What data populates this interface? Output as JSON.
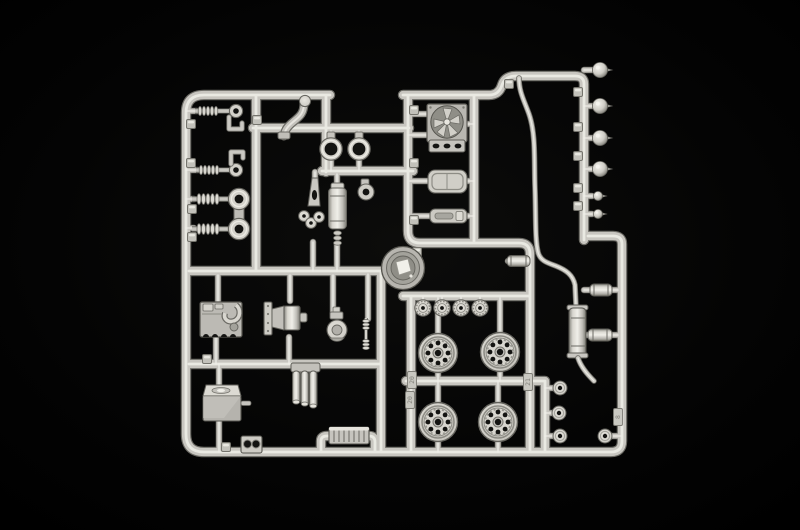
{
  "meta": {
    "description": "Photograph of a light-gray injection-molded plastic model kit sprue (parts runner) lying on a black background",
    "subject": "model-kit-sprue",
    "plastic_color_name": "light gray",
    "background_color_name": "black"
  },
  "palette": {
    "bg": "#000000",
    "vign": "#0d0d0c",
    "plastic_hi": "#efeee8",
    "plastic_mid": "#c8c6c0",
    "plastic_lo": "#a3a29b",
    "plastic_dark": "#6b6a64",
    "hole": "#141412"
  },
  "sprue": {
    "tags": [
      {
        "label": "20"
      },
      {
        "label": "20"
      },
      {
        "label": "21"
      },
      {
        "label": "8"
      }
    ],
    "counts": {
      "road_wheels": 4,
      "idler_wheels": 4,
      "headlamp_bulbs_large": 4,
      "headlamp_bulbs_small": 2,
      "hubcap_discs": 4,
      "mounting_rings": 2,
      "shock_absorbers": 4
    },
    "parts": [
      {
        "name": "shock-absorber-small",
        "desc": "coil spring with tow eye, upper left, two of them"
      },
      {
        "name": "l-bracket",
        "desc": "small L-shaped bracket next to each small shock"
      },
      {
        "name": "shock-absorber-large-pair",
        "desc": "two linked shocks with large ring eyes"
      },
      {
        "name": "exhaust-manifold-elbow",
        "desc": "S-curved thick pipe with round flange"
      },
      {
        "name": "mounting-ring",
        "desc": "donut ring part, two side by side"
      },
      {
        "name": "air-filter-canister",
        "desc": "vertical cylinder with cap"
      },
      {
        "name": "engine-mount-bracket",
        "desc": "small bracket with round hole"
      },
      {
        "name": "pedal-assembly",
        "desc": "Y-shaped part with three round feet"
      },
      {
        "name": "radiator-with-fan",
        "desc": "square shroud with six-blade fan and slotted tank"
      },
      {
        "name": "seat-pan",
        "desc": "rounded rectangular pan"
      },
      {
        "name": "step-plate",
        "desc": "low flat plate with slot"
      },
      {
        "name": "horn-drum",
        "desc": "large circular drum with bright center reflector"
      },
      {
        "name": "idler-wheel",
        "desc": "small serrated wheel, row of four"
      },
      {
        "name": "road-wheel",
        "desc": "steel wheel with eight lightening holes, four total"
      },
      {
        "name": "engine-block",
        "desc": "block with intake hook and four cylinder arches"
      },
      {
        "name": "gearbox",
        "desc": "bell housing with bolt flange and output stub"
      },
      {
        "name": "fuel-pump-carburetor",
        "desc": "round body with stack"
      },
      {
        "name": "damper-rod",
        "desc": "thin rod with two coil springs"
      },
      {
        "name": "fuel-tank",
        "desc": "box tank with filler lid and spout"
      },
      {
        "name": "triple-tube-assembly",
        "desc": "three capped tubes under a bracket"
      },
      {
        "name": "heater-core",
        "desc": "finned block on raised bottom bracket"
      },
      {
        "name": "twin-gauge-bezel",
        "desc": "small block with two round holes"
      },
      {
        "name": "exhaust-pipe-muffler",
        "desc": "long wavy pipe into ribbed muffler with tailpipe"
      },
      {
        "name": "inline-filter",
        "desc": "small horizontal cylinder on the pipe run"
      },
      {
        "name": "pipe-coupling",
        "desc": "short cylinder between runners, two of them"
      },
      {
        "name": "headlamp-bulb",
        "desc": "round bulb with pointed tip, column of four large and two small"
      },
      {
        "name": "hubcap-disc",
        "desc": "flat disc with center hole, four near bottom right"
      },
      {
        "name": "sprue-gate-tab",
        "desc": "small square molding nubs along runners"
      }
    ]
  }
}
